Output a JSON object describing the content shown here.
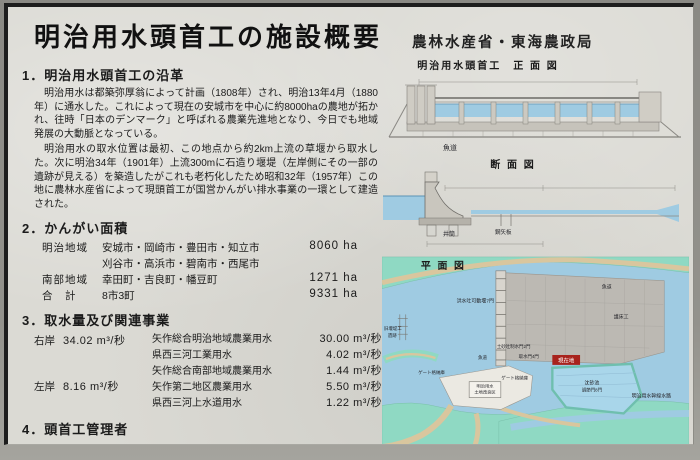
{
  "sign": {
    "title": "明治用水頭首工の施設概要",
    "agency": "農林水産省・東海農政局"
  },
  "sections": {
    "s1": {
      "heading": "1．明治用水頭首工の沿革",
      "para1": "明治用水は都築弥厚翁によって計画（1808年）され、明治13年4月（1880年）に通水した。これによって現在の安城市を中心に約8000haの農地が拓かれ、往時「日本のデンマーク」と呼ばれる農業先進地となり、今日でも地域発展の大動脈となっている。",
      "para2": "明治用水の取水位置は最初、この地点から約2km上流の草堰から取水した。次に明治34年（1901年）上流300mに石造り堰堤（左岸側にその一部の遺跡が見える）を築造したがこれも老朽化したため昭和32年（1957年）この地に農林水産省によって現頭首工が国営かんがい排水事業の一環として建造された。"
    },
    "s2": {
      "heading": "2．かんがい面積",
      "rows": [
        {
          "label": "明治地域",
          "cities": "安城市・岡崎市・豊田市・知立市",
          "area": "8060 ha"
        },
        {
          "label": "",
          "cities": "刈谷市・高浜市・碧南市・西尾市",
          "area": ""
        },
        {
          "label": "南部地域",
          "cities": "幸田町・吉良町・幡豆町",
          "area": "1271 ha"
        },
        {
          "label": "合　計",
          "cities": "8市3町",
          "area": "9331 ha"
        }
      ]
    },
    "s3": {
      "heading": "3．取水量及び関連事業",
      "banks": [
        {
          "label": "右岸",
          "value": "34.02 m³/秒"
        },
        {
          "label": "左岸",
          "value": "8.16 m³/秒"
        }
      ],
      "items": [
        {
          "name": "矢作総合明治地域農業用水",
          "value": "30.00 m³/秒"
        },
        {
          "name": "県西三河工業用水",
          "value": "4.02 m³/秒"
        },
        {
          "name": "矢作総合南部地域農業用水",
          "value": "1.44 m³/秒"
        },
        {
          "name": "矢作第二地区農業用水",
          "value": "5.50 m³/秒"
        },
        {
          "name": "県西三河上水道用水",
          "value": "1.22 m³/秒"
        }
      ]
    },
    "s4": {
      "heading": "4．頭首工管理者",
      "org": "明治用水土地改良区",
      "address": "安城市大東町",
      "tel": "TEL.0566.76-6241"
    }
  },
  "figures": {
    "front": {
      "title": "明治用水頭首工　正 面 図",
      "labels": {
        "fishway": "魚道"
      }
    },
    "cross": {
      "title": "断 面 図",
      "labels": {
        "caisson": "井筒",
        "sheet_pile": "鋼矢板"
      }
    },
    "plan": {
      "title": "平 面 図",
      "labels": {
        "flood_gates": "洪水吐可動堰7門",
        "sand_gates": "土砂吐制水門2門",
        "intake_gates": "取水門4門",
        "fishway": "魚道",
        "fishway2": "魚道",
        "apron": "護床工",
        "old_weir1": "旧堰堤工",
        "old_weir2": "遺跡",
        "gate_house1": "ゲート格納庫",
        "gate_house2": "ゲート格納庫",
        "office1": "明治用水",
        "office2": "土地改良区",
        "basin": "沈砂池",
        "basin_gates": "調節門8門",
        "canal": "明治用水幹線水路",
        "here": "現在地"
      }
    }
  },
  "colors": {
    "water": "#9fcbe2",
    "bank_green": "#8fd9c3",
    "road_tan": "#d9c69e",
    "concrete": "#bdbab4",
    "marker_red": "#a8231d"
  }
}
